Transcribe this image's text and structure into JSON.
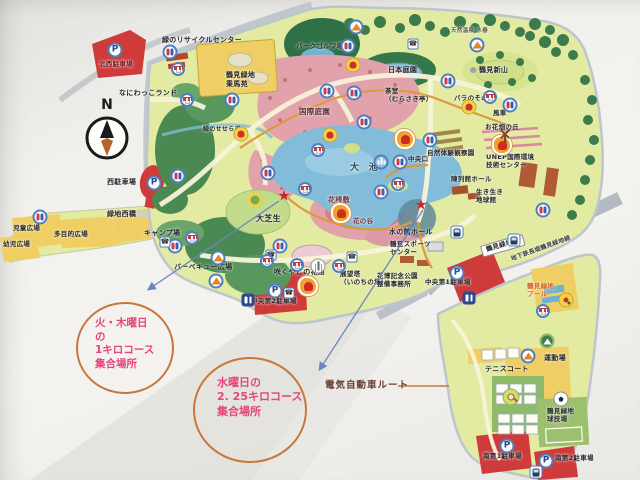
{
  "compass": {
    "label": "N"
  },
  "annotations": {
    "meeting_point_1": {
      "text": "火・木曜日\nの\n1キロコース\n集合場所"
    },
    "meeting_point_2": {
      "text": "水曜日の\n2. 25キロコース\n集合場所"
    },
    "ev_route": {
      "label": "電気自動車ルート"
    }
  },
  "colors": {
    "annotation_circle": "#c8763c",
    "annotation_text": "#e5447c",
    "arrow": "#6b84c4",
    "star": "#c22a3c",
    "ev_line": "#c8763c",
    "map_base": "#e3eaa2",
    "pond": "#82bcd9",
    "parking_red": "#cf3a3a"
  },
  "icon_glyphs": {
    "parking": "P",
    "phone": "☎",
    "star": "★"
  },
  "map": {
    "labels": [
      {
        "t": "北西駐車場",
        "x": 99,
        "y": 61,
        "s": 6.5,
        "c": "#6e1a1e"
      },
      {
        "t": "緑のリサイクルセンター",
        "x": 162,
        "y": 36,
        "s": 7
      },
      {
        "t": "なにわっこランド",
        "x": 119,
        "y": 89,
        "s": 7
      },
      {
        "t": "鶴見緑地\n乗馬苑",
        "x": 226,
        "y": 71,
        "s": 7
      },
      {
        "t": "パークゴルフ場",
        "x": 296,
        "y": 43,
        "s": 6.5
      },
      {
        "t": "日本庭園",
        "x": 388,
        "y": 66,
        "s": 7
      },
      {
        "t": "鶴見新山",
        "x": 479,
        "y": 66,
        "s": 7
      },
      {
        "t": "天然温泉 水春",
        "x": 451,
        "y": 28,
        "s": 5.5,
        "c": "#555a50"
      },
      {
        "t": "バラのその",
        "x": 454,
        "y": 95,
        "s": 6.5
      },
      {
        "t": "茶室\n（むらさき亭）",
        "x": 385,
        "y": 88,
        "s": 6.5
      },
      {
        "t": "国際庭園",
        "x": 299,
        "y": 107,
        "s": 7.5,
        "c": "#5c3038"
      },
      {
        "t": "大　池",
        "x": 350,
        "y": 163,
        "s": 9,
        "c": "#2e4a5a"
      },
      {
        "t": "花桟敷",
        "x": 328,
        "y": 196,
        "s": 7,
        "c": "#7c3038"
      },
      {
        "t": "花の谷",
        "x": 353,
        "y": 218,
        "s": 6.5,
        "c": "#7c3038"
      },
      {
        "t": "大芝生",
        "x": 256,
        "y": 214,
        "s": 8
      },
      {
        "t": "緑のせせらぎ",
        "x": 203,
        "y": 126,
        "s": 6
      },
      {
        "t": "西駐車場",
        "x": 107,
        "y": 178,
        "s": 7
      },
      {
        "t": "緑地西橋",
        "x": 107,
        "y": 210,
        "s": 7
      },
      {
        "t": "児童広場",
        "x": 13,
        "y": 225,
        "s": 6.5
      },
      {
        "t": "多目的広場",
        "x": 54,
        "y": 231,
        "s": 6.5
      },
      {
        "t": "幼児広場",
        "x": 3,
        "y": 241,
        "s": 6.5
      },
      {
        "t": "キャンプ場",
        "x": 144,
        "y": 229,
        "s": 7
      },
      {
        "t": "バーベキュー広場",
        "x": 174,
        "y": 263,
        "s": 7
      },
      {
        "t": "咲くやこの花館",
        "x": 274,
        "y": 268,
        "s": 7
      },
      {
        "t": "展望塔\n（いのちの塔）",
        "x": 340,
        "y": 271,
        "s": 6.5
      },
      {
        "t": "花博記念公園\n整備事務所",
        "x": 377,
        "y": 273,
        "s": 6.5
      },
      {
        "t": "水の館ホール",
        "x": 389,
        "y": 228,
        "s": 7
      },
      {
        "t": "鶴見スポーツ\nセンター",
        "x": 390,
        "y": 241,
        "s": 6.5
      },
      {
        "t": "中央第2駐車場",
        "x": 251,
        "y": 298,
        "s": 6.5
      },
      {
        "t": "中央第1駐車場",
        "x": 425,
        "y": 279,
        "s": 6.5
      },
      {
        "t": "鶴見緑地駅",
        "x": 480,
        "y": 246,
        "s": 6.5,
        "r": -16,
        "bx": true
      },
      {
        "t": "地下鉄長堀鶴見緑地線",
        "x": 510,
        "y": 256,
        "s": 6,
        "r": -20,
        "c": "#3a3f46"
      },
      {
        "t": "鶴見緑地\nプール",
        "x": 527,
        "y": 283,
        "s": 6.5,
        "c": "#d4601a"
      },
      {
        "t": "運動場",
        "x": 544,
        "y": 354,
        "s": 7
      },
      {
        "t": "テニスコート",
        "x": 485,
        "y": 365,
        "s": 7
      },
      {
        "t": "鶴見緑地\n球技場",
        "x": 547,
        "y": 408,
        "s": 6.5
      },
      {
        "t": "南第1駐車場",
        "x": 483,
        "y": 453,
        "s": 6.5
      },
      {
        "t": "南第2駐車場",
        "x": 555,
        "y": 455,
        "s": 6.5
      },
      {
        "t": "中央口",
        "x": 408,
        "y": 156,
        "s": 6.5
      },
      {
        "t": "自然体験観察園",
        "x": 427,
        "y": 150,
        "s": 6.5
      },
      {
        "t": "UNEP国際環境\n技術センター",
        "x": 486,
        "y": 154,
        "s": 6.5
      },
      {
        "t": "陳列館ホール",
        "x": 451,
        "y": 176,
        "s": 6.5
      },
      {
        "t": "生き生き\n地球館",
        "x": 476,
        "y": 189,
        "s": 6.5
      },
      {
        "t": "風車",
        "x": 493,
        "y": 110,
        "s": 6.5
      },
      {
        "t": "お花畑の丘",
        "x": 485,
        "y": 124,
        "s": 6.5
      }
    ],
    "icons": [
      {
        "t": "toilet",
        "x": 170,
        "y": 52
      },
      {
        "t": "toilet",
        "x": 232,
        "y": 100
      },
      {
        "t": "toilet",
        "x": 348,
        "y": 46
      },
      {
        "t": "toilet",
        "x": 327,
        "y": 91
      },
      {
        "t": "toilet",
        "x": 354,
        "y": 93
      },
      {
        "t": "toilet",
        "x": 448,
        "y": 81
      },
      {
        "t": "toilet",
        "x": 510,
        "y": 105
      },
      {
        "t": "toilet",
        "x": 364,
        "y": 122
      },
      {
        "t": "toilet",
        "x": 430,
        "y": 140
      },
      {
        "t": "toilet",
        "x": 268,
        "y": 173
      },
      {
        "t": "toilet",
        "x": 381,
        "y": 192
      },
      {
        "t": "toilet",
        "x": 400,
        "y": 162
      },
      {
        "t": "toilet",
        "x": 178,
        "y": 176
      },
      {
        "t": "toilet",
        "x": 40,
        "y": 217
      },
      {
        "t": "toilet",
        "x": 175,
        "y": 246
      },
      {
        "t": "toilet",
        "x": 280,
        "y": 246
      },
      {
        "t": "toilet",
        "x": 543,
        "y": 210
      },
      {
        "t": "toiletd",
        "x": 248,
        "y": 300
      },
      {
        "t": "toiletd",
        "x": 469,
        "y": 298
      },
      {
        "t": "parking",
        "x": 115,
        "y": 50
      },
      {
        "t": "parking",
        "x": 154,
        "y": 183
      },
      {
        "t": "parking",
        "x": 275,
        "y": 291
      },
      {
        "t": "parking",
        "x": 457,
        "y": 273
      },
      {
        "t": "parking",
        "x": 507,
        "y": 446
      },
      {
        "t": "parking",
        "x": 546,
        "y": 461
      },
      {
        "t": "phone",
        "x": 413,
        "y": 44
      },
      {
        "t": "phone",
        "x": 165,
        "y": 242
      },
      {
        "t": "phone",
        "x": 271,
        "y": 255
      },
      {
        "t": "phone",
        "x": 352,
        "y": 257
      },
      {
        "t": "phone",
        "x": 289,
        "y": 293
      },
      {
        "t": "shop",
        "x": 178,
        "y": 69
      },
      {
        "t": "shop",
        "x": 187,
        "y": 100
      },
      {
        "t": "shop",
        "x": 318,
        "y": 150
      },
      {
        "t": "shop",
        "x": 305,
        "y": 189
      },
      {
        "t": "shop",
        "x": 398,
        "y": 184
      },
      {
        "t": "shop",
        "x": 490,
        "y": 97
      },
      {
        "t": "shop",
        "x": 267,
        "y": 261
      },
      {
        "t": "shop",
        "x": 297,
        "y": 265
      },
      {
        "t": "shop",
        "x": 339,
        "y": 266
      },
      {
        "t": "shop",
        "x": 543,
        "y": 311
      },
      {
        "t": "shop",
        "x": 192,
        "y": 238
      },
      {
        "t": "tulipy",
        "x": 353,
        "y": 65
      },
      {
        "t": "tulipy",
        "x": 469,
        "y": 107
      },
      {
        "t": "tulipy",
        "x": 241,
        "y": 134
      },
      {
        "t": "tulipy",
        "x": 330,
        "y": 135
      },
      {
        "t": "tulipo",
        "x": 341,
        "y": 213
      },
      {
        "t": "tulipo",
        "x": 308,
        "y": 286
      },
      {
        "t": "tulipo",
        "x": 502,
        "y": 145
      },
      {
        "t": "tulipo",
        "x": 405,
        "y": 139
      },
      {
        "t": "shelter",
        "x": 356,
        "y": 27
      },
      {
        "t": "shelter",
        "x": 477,
        "y": 45
      },
      {
        "t": "shelter",
        "x": 528,
        "y": 356
      },
      {
        "t": "shelter",
        "x": 218,
        "y": 258
      },
      {
        "t": "shelter",
        "x": 216,
        "y": 281
      },
      {
        "t": "fountain",
        "x": 381,
        "y": 162
      },
      {
        "t": "lawn",
        "x": 255,
        "y": 200
      },
      {
        "t": "tower",
        "x": 318,
        "y": 266
      },
      {
        "t": "train",
        "x": 514,
        "y": 240
      },
      {
        "t": "train",
        "x": 457,
        "y": 232
      },
      {
        "t": "train",
        "x": 536,
        "y": 472
      },
      {
        "t": "tennis",
        "x": 511,
        "y": 397
      },
      {
        "t": "soccer",
        "x": 561,
        "y": 399
      },
      {
        "t": "play",
        "x": 566,
        "y": 300
      },
      {
        "t": "parkg",
        "x": 547,
        "y": 341
      },
      {
        "t": "windmill",
        "x": 505,
        "y": 120
      }
    ],
    "stars": [
      {
        "x": 284,
        "y": 196
      },
      {
        "x": 421,
        "y": 205
      }
    ],
    "arrows": [
      {
        "x1": 279,
        "y1": 201,
        "x2": 149,
        "y2": 289
      },
      {
        "x1": 423,
        "y1": 210,
        "x2": 320,
        "y2": 369
      }
    ],
    "ev_legend_line": {
      "x1": 398,
      "y1": 386,
      "x2": 449,
      "y2": 386
    }
  }
}
